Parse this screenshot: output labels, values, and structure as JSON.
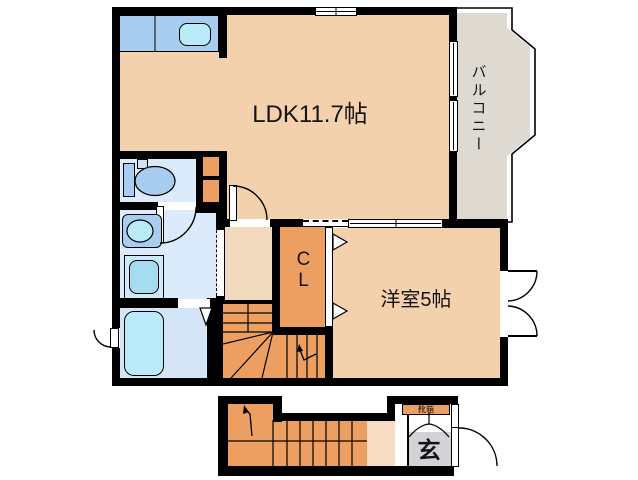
{
  "floorplan": {
    "rooms": {
      "ldk": {
        "label": "LDK11.7帖"
      },
      "balcony": {
        "label": "バルコニー"
      },
      "western_room": {
        "label": "洋室5帖"
      },
      "closet": {
        "label": "CL"
      },
      "entrance": {
        "label": "玄"
      },
      "shoe_cabinet": {
        "label": "靴箱"
      }
    },
    "colors": {
      "wall": "#000000",
      "room": "#f2d1ac",
      "hall": "#f1d9bd",
      "hall1f": "#f6ddc2",
      "orange": "#ed9f62",
      "balcony": "#dedad2",
      "genkan": "#d2d3d7",
      "wet": "#dcebfb",
      "bath": "#d3e5f7",
      "fixture": "#a9cdf0",
      "water": "#b9ecf8",
      "machine": "#cde9fa",
      "machineinner": "#a5dcf2",
      "text": "#141414"
    }
  }
}
